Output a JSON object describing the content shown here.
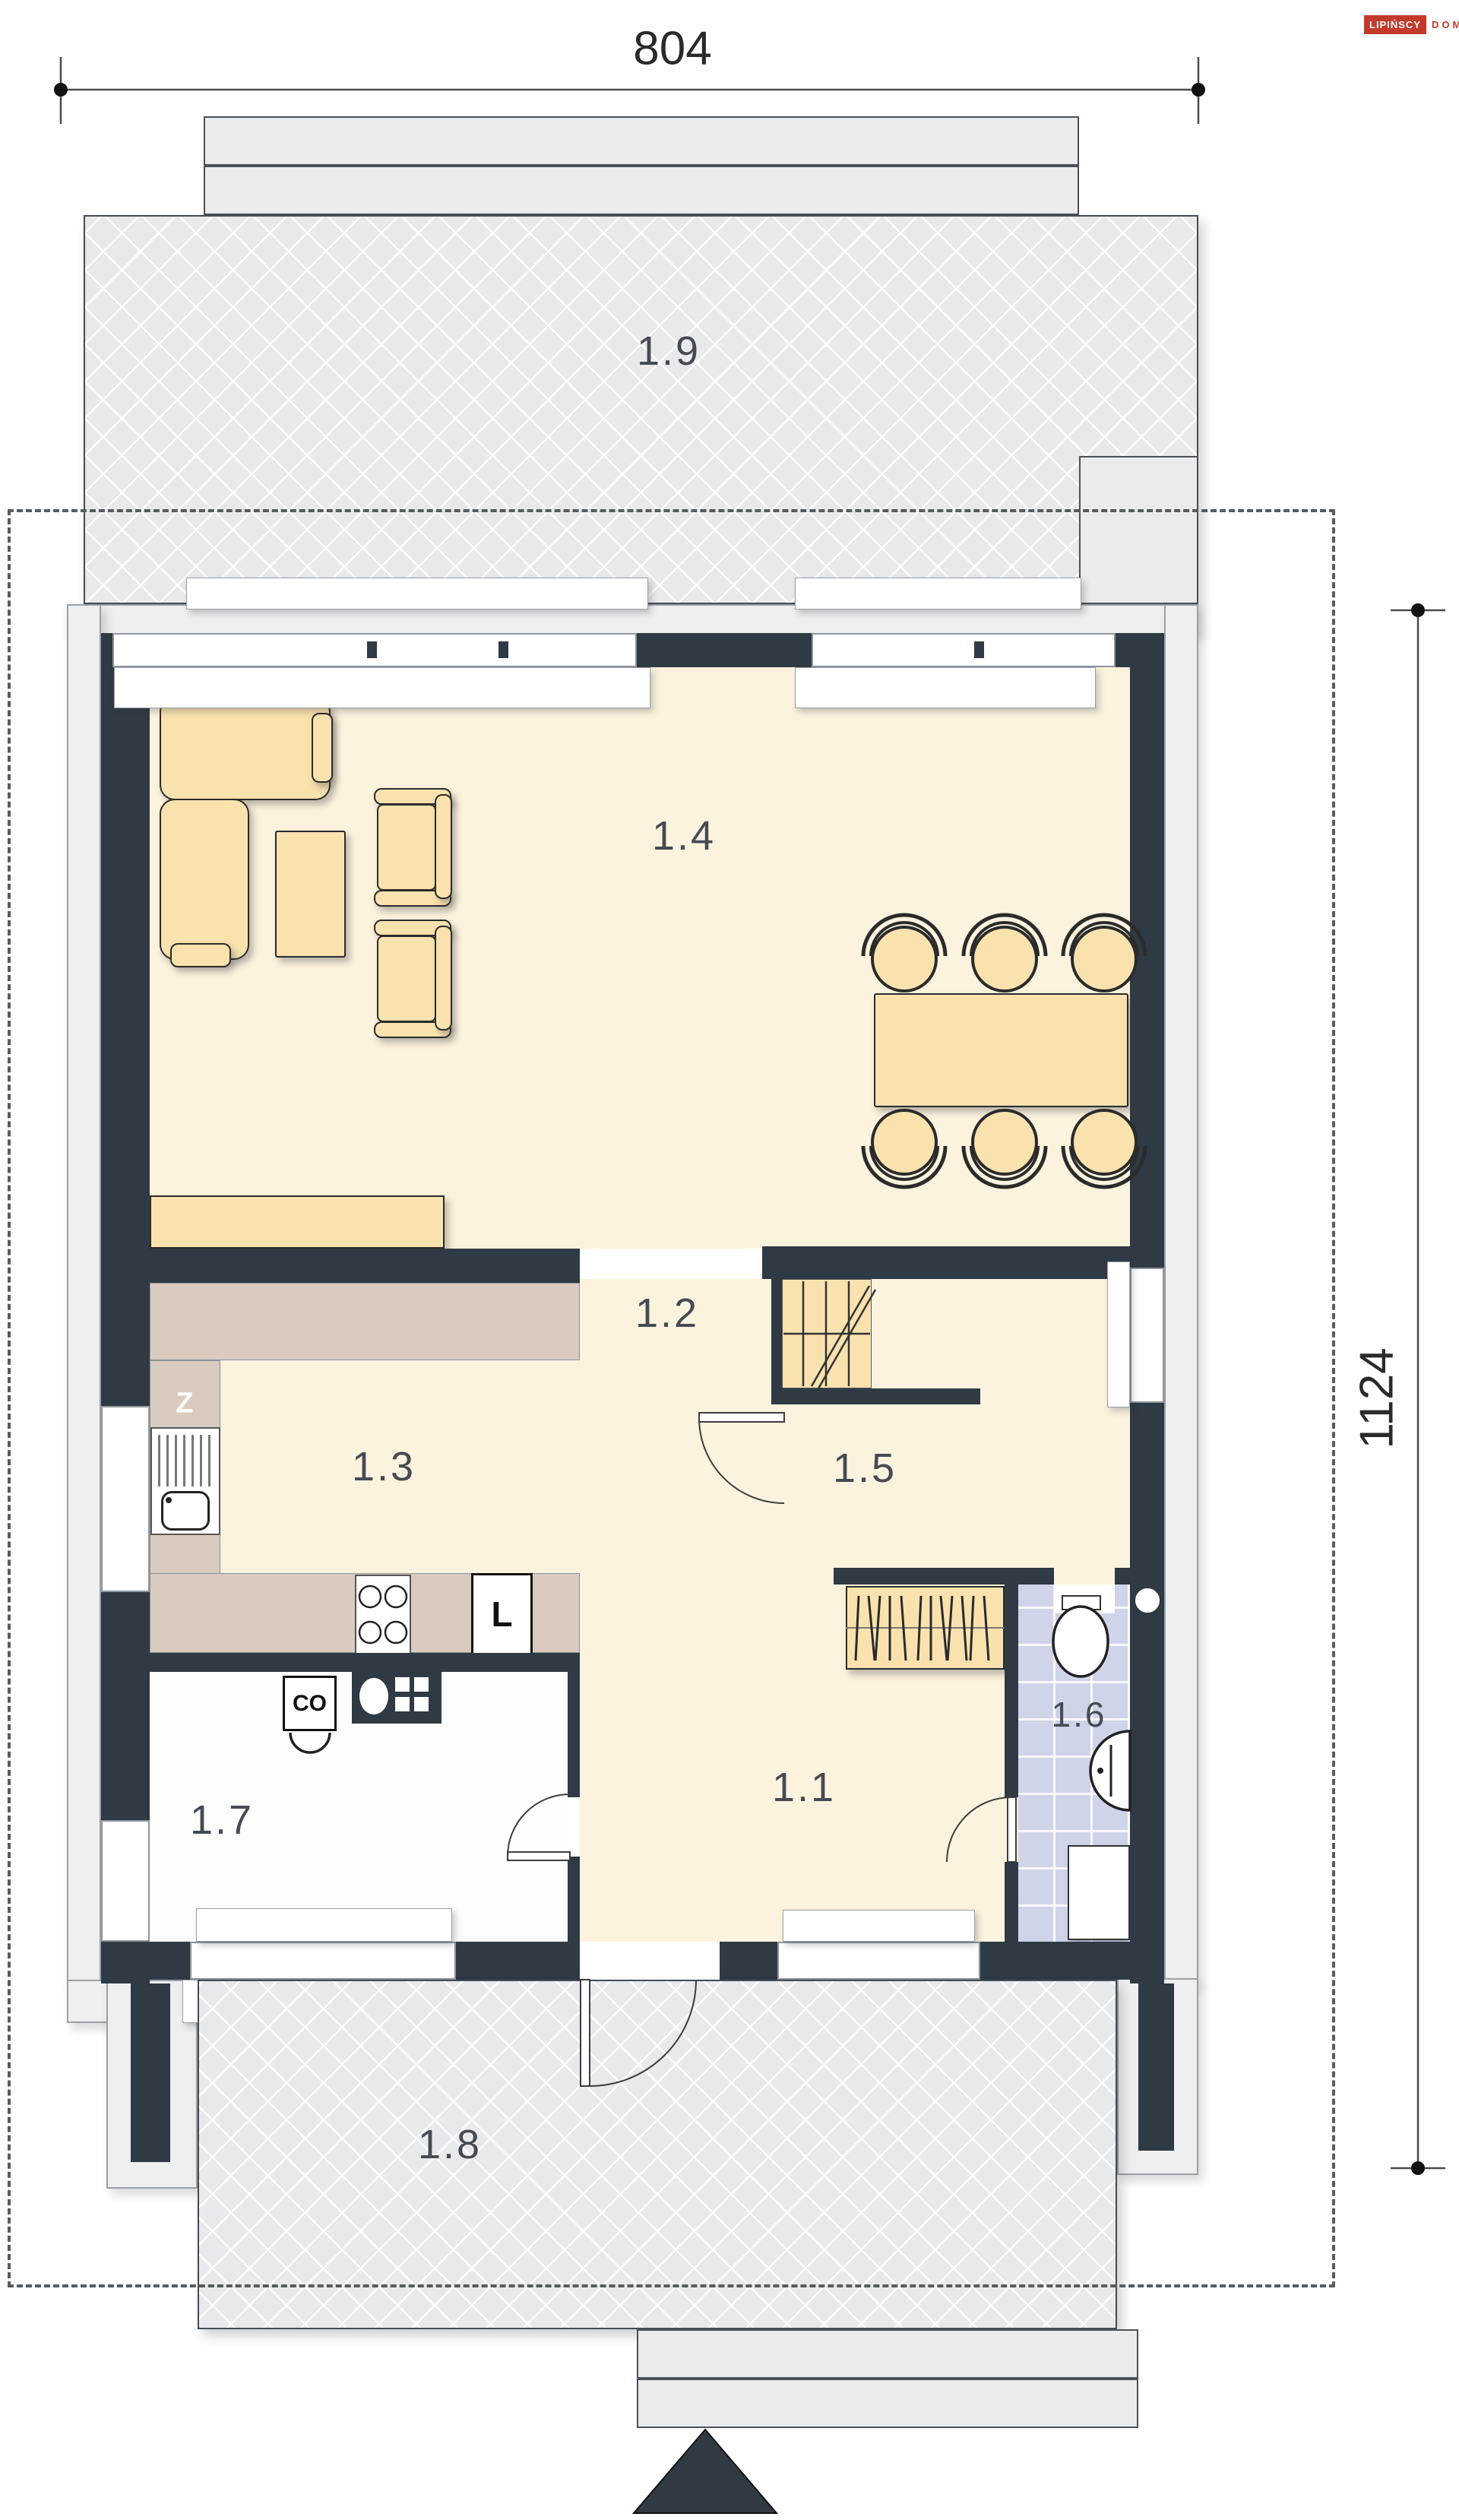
{
  "logo": {
    "brand": "LIPIŃSCY",
    "suffix": "DOMY"
  },
  "dimensions": {
    "width": "804",
    "height": "1124"
  },
  "rooms": [
    {
      "id": "1.1",
      "label": "1.1"
    },
    {
      "id": "1.2",
      "label": "1.2"
    },
    {
      "id": "1.3",
      "label": "1.3"
    },
    {
      "id": "1.4",
      "label": "1.4"
    },
    {
      "id": "1.5",
      "label": "1.5"
    },
    {
      "id": "1.6",
      "label": "1.6"
    },
    {
      "id": "1.7",
      "label": "1.7"
    },
    {
      "id": "1.8",
      "label": "1.8"
    },
    {
      "id": "1.9",
      "label": "1.9"
    }
  ],
  "markers": {
    "sink": "Z",
    "fridge": "L",
    "boiler": "CO"
  },
  "colors": {
    "wall": "#2f3a44",
    "floor": "#fcf3de",
    "furniture": "#f9e2ae",
    "counter": "#d9cbbf",
    "terrace": "#e7e9ec",
    "bath_floor": "#cfd4e9",
    "accent_red": "#c23a2c"
  }
}
